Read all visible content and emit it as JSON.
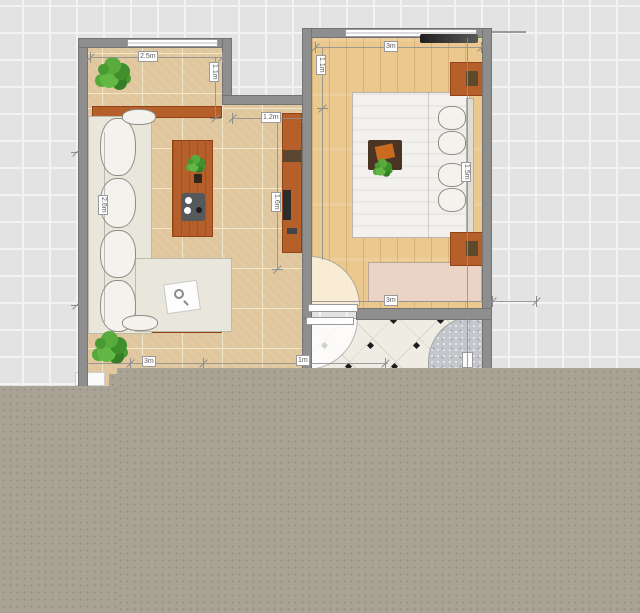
{
  "view": {
    "type": "2d-floor-plan",
    "rooms": [
      "living-room",
      "bedroom",
      "bathroom"
    ],
    "colors": {
      "canvas_grid": "#e3e3e3",
      "overlay_block": "#a9a396",
      "wall": "#8e8e8e",
      "living_floor_tile": "#e0c69c",
      "bedroom_floor_wood": "#ebc88e",
      "bathroom_tile": "#efece4",
      "furniture_wood": "#b5602a"
    }
  },
  "dimensions": {
    "living_top": "2.5m",
    "living_top_side": "1.1m",
    "passage_width": "1.2m",
    "cabinet_height": "1.6m",
    "sofa_length": "2.6m",
    "living_bottom": "3m",
    "living_bottom_right": "1m",
    "bedroom_top": "3m",
    "bedroom_left": "1.1m",
    "bed_length": "1.5m",
    "bathroom_width": "3m"
  }
}
